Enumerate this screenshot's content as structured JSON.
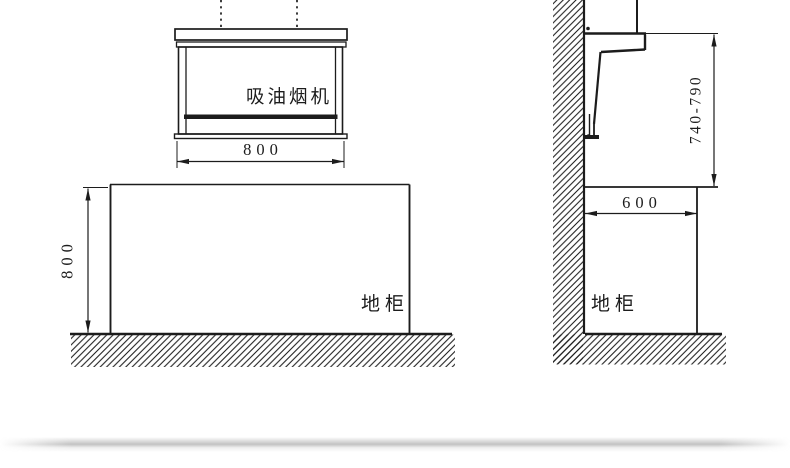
{
  "diagram": {
    "kind": "range-hood-installation-dimension-drawing",
    "front_view": {
      "hood_label": "吸油烟机",
      "hood_width": "800",
      "cabinet_label": "地柜",
      "cabinet_height": "800"
    },
    "side_view": {
      "hood_bottom_height_range": "740-790",
      "countertop_depth": "600",
      "cabinet_label": "地柜"
    },
    "colors": {
      "line": "#1c1c1c",
      "background": "#ffffff"
    }
  }
}
